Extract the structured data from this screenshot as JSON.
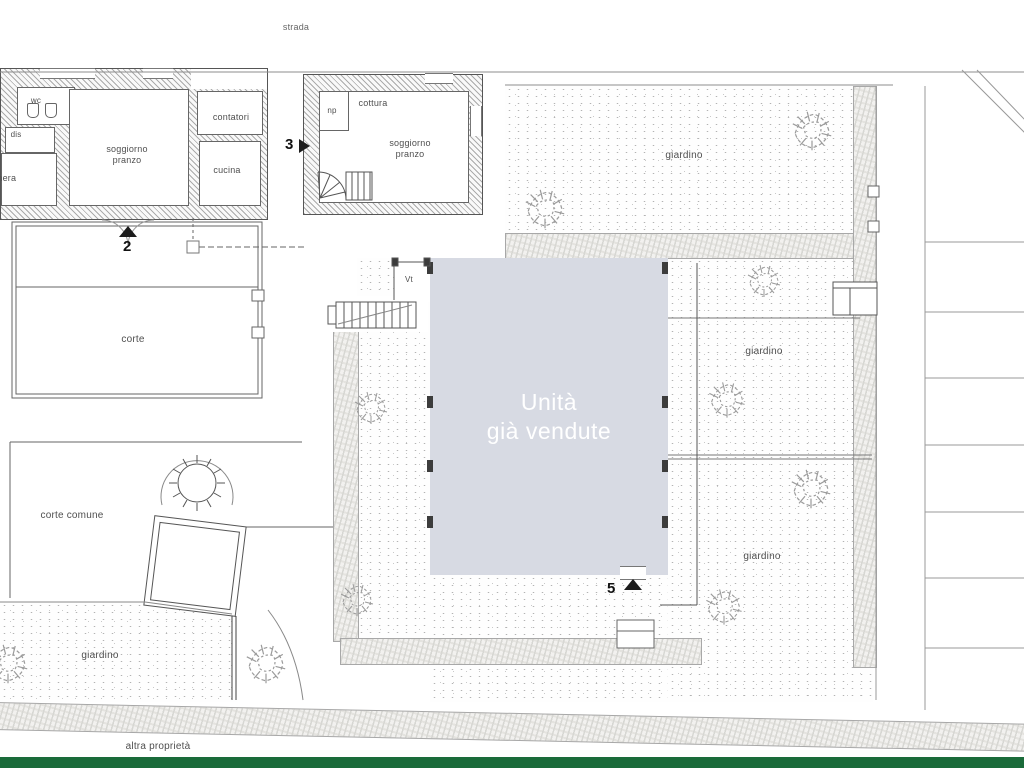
{
  "plan_type": "architectural-site-plan",
  "labels": {
    "street": "strada",
    "other_property": "altra proprietà",
    "garden": "giardino",
    "court": "corte",
    "common_court": "corte comune",
    "vestibule": "Vt"
  },
  "left_unit": {
    "number": "2",
    "rooms": {
      "wc": "wc",
      "hallway": "dis",
      "bedroom": "camera",
      "living": "soggiorno\npranzo",
      "meters": "contatori",
      "kitchen": "cucina"
    }
  },
  "middle_unit": {
    "number": "3",
    "rooms": {
      "closet": "np",
      "cooking": "cottura",
      "living": "soggiorno\npranzo"
    }
  },
  "sold_units": {
    "number": "5",
    "label": "Unità\ngià vendute"
  },
  "colors": {
    "sold_fill": "#d7dae3",
    "sold_text": "#ffffff",
    "green_bar": "#1a6b3a"
  }
}
